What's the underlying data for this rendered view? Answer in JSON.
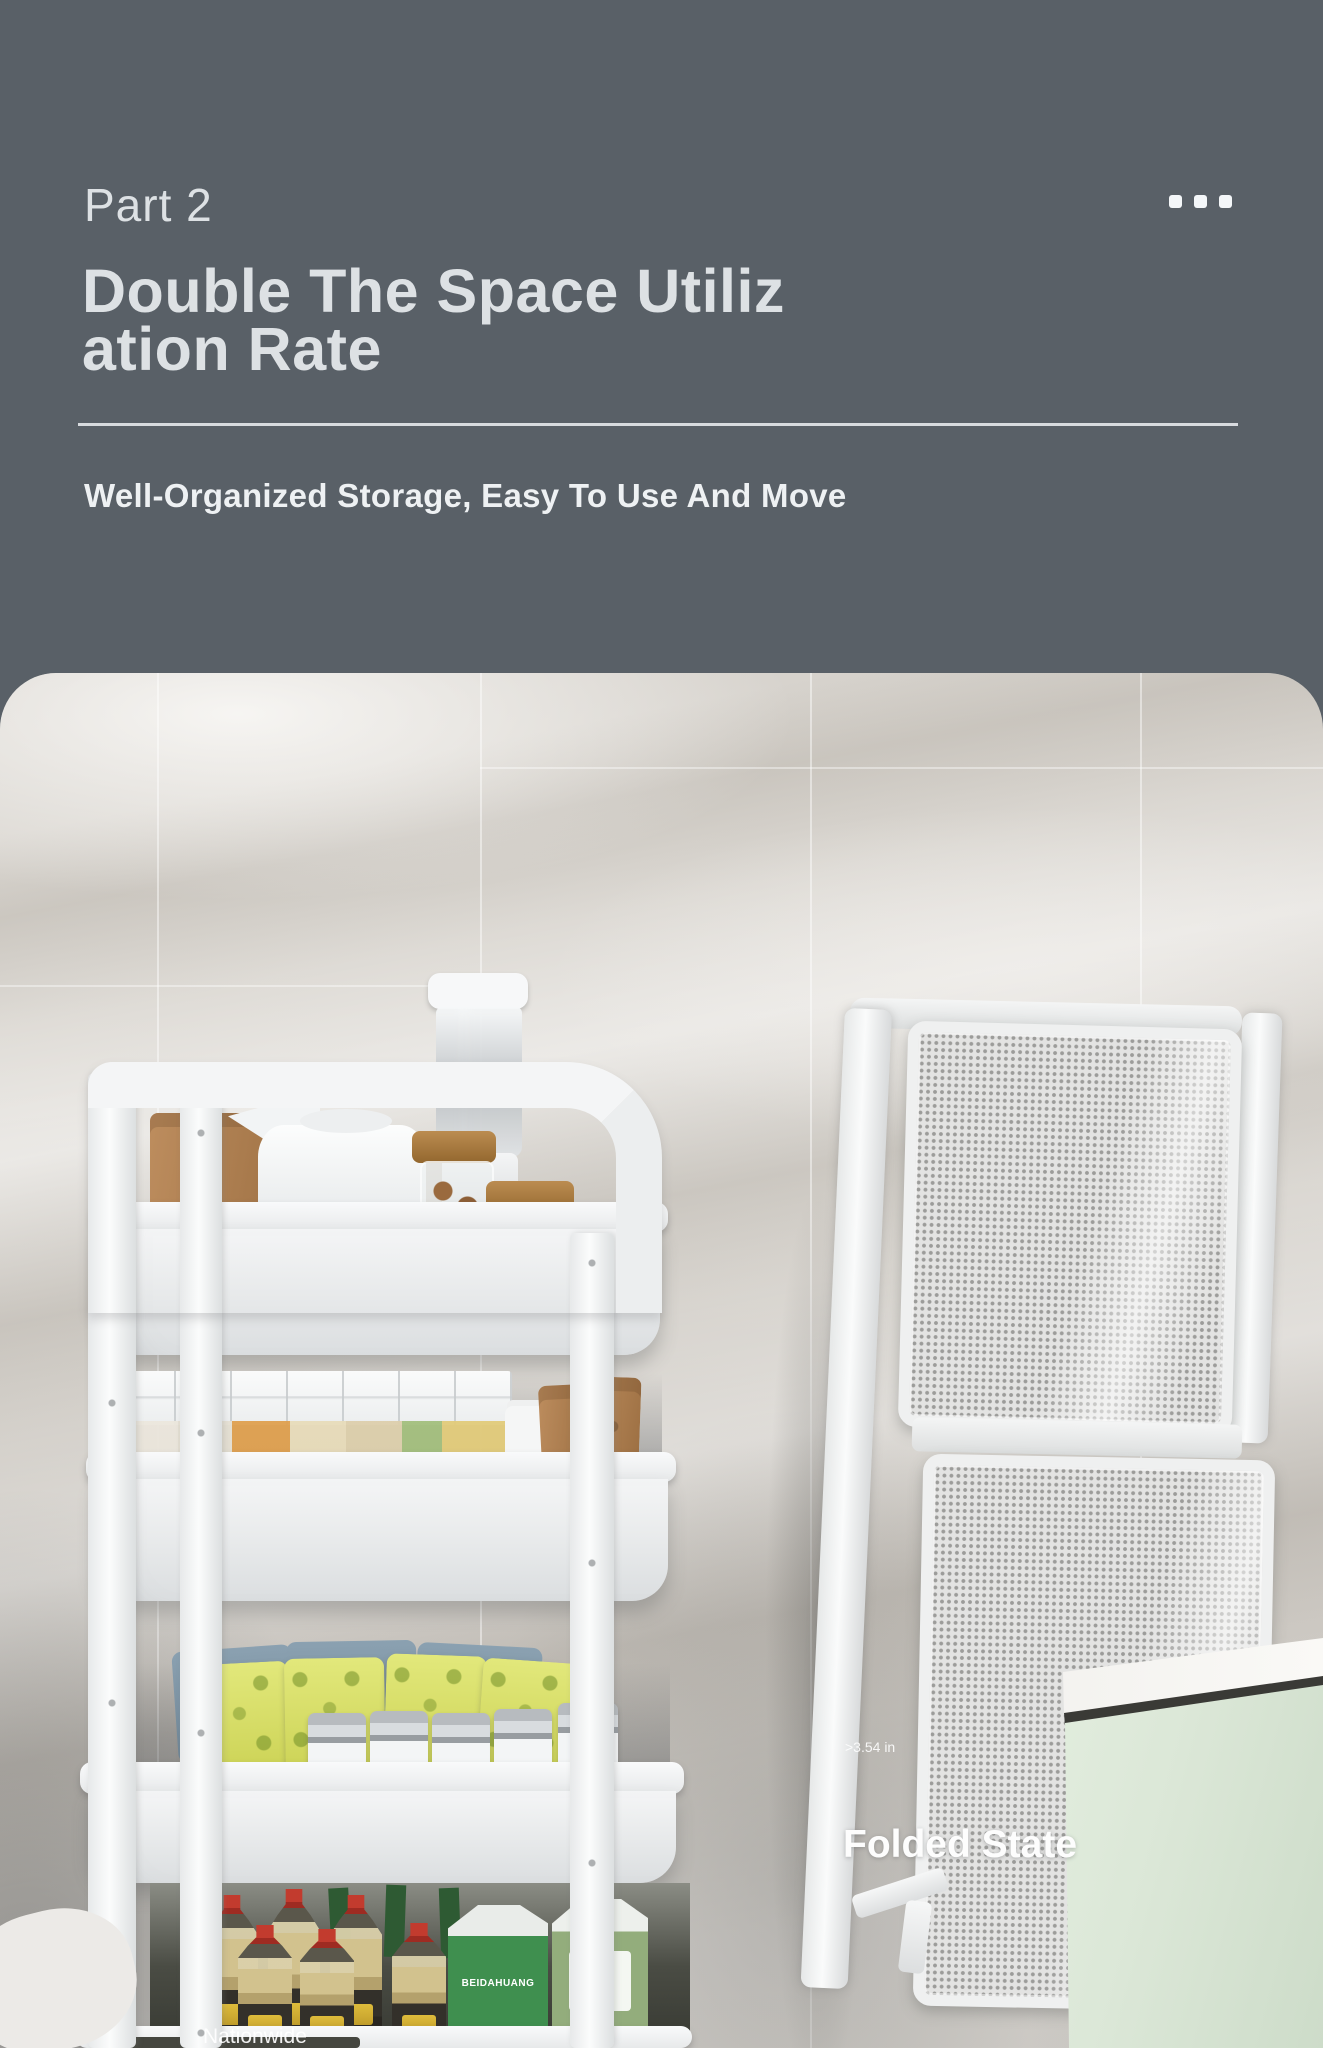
{
  "header": {
    "part_label": "Part 2",
    "title_line1": "Double The Space Utiliz",
    "title_line2": "ation Rate",
    "subtitle": "Well-Organized Storage, Easy To Use And Move"
  },
  "photo": {
    "dimension_label": ">3.54 in",
    "folded_state_label": "Folded State",
    "bottom_partial_text": "Nationwide",
    "carton_brand": "BEIDAHUANG"
  },
  "icons": {
    "menu": "ellipsis-icon"
  },
  "theme": {
    "hero_bg": "#596067",
    "hero_text": "#dde1e4",
    "hero_subtitle": "#eef1f3",
    "divider": "#e3e6e9",
    "dot": "#f4f7f9",
    "panel_frame": "#eff0f0",
    "mesh_bg": "#e3e3e2",
    "mesh_dot": "#9c9c9a",
    "cabinet_green": "#dbe7d7",
    "cabinet_top": "#f3f2ef",
    "corn": "#dfa04f",
    "beans": "#a3bf7d",
    "pasta": "#e2cb7a",
    "carton_green": "#3f8f4f",
    "carton_green2": "#93ad7c",
    "cap_red": "#c23b2e",
    "label_yellow": "#e7c33c"
  }
}
